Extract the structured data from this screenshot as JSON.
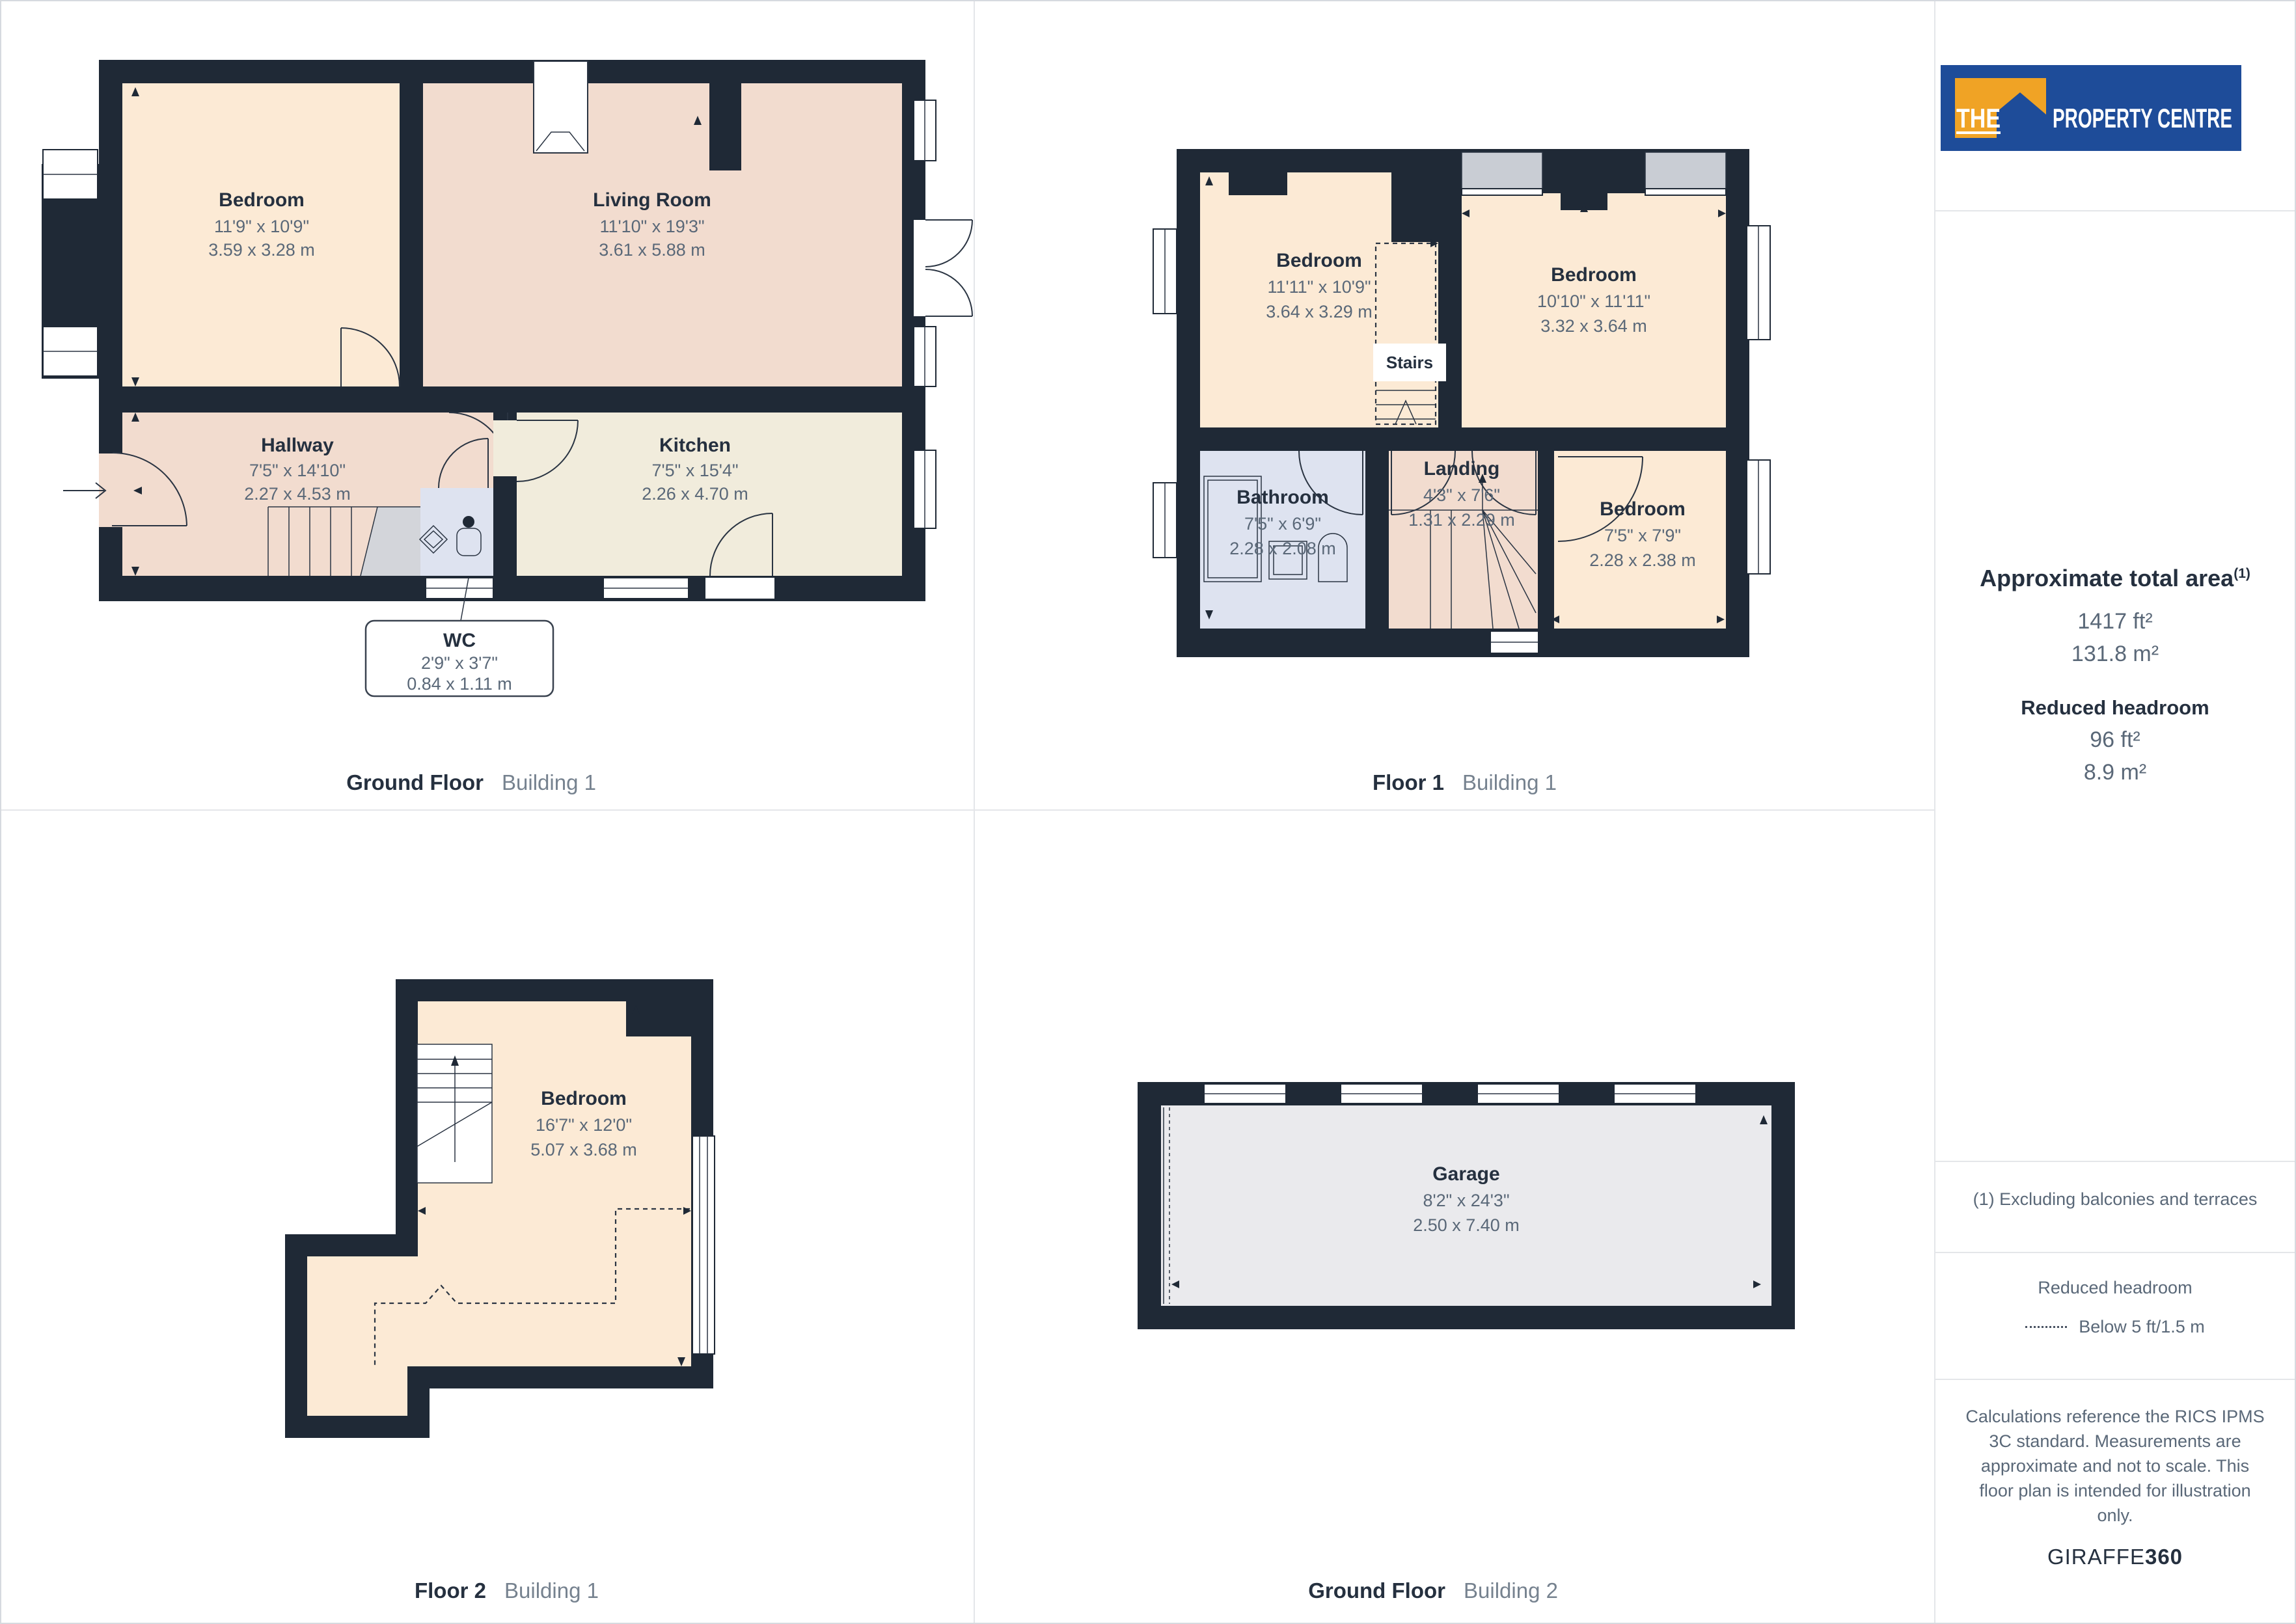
{
  "colors": {
    "wall": "#1F2936",
    "peach": "#FCEAD5",
    "pink": "#F2DCCF",
    "beige": "#F1ECDC",
    "blue": "#DEE3F0",
    "grey": "#EAEAED",
    "stair": "#D3D5DA",
    "sill": "#C9CDD4",
    "ink": "#25303F",
    "dim": "#5A6878",
    "light": "#76828F",
    "line": "#E4E6E9",
    "thin": "#2A3442",
    "logoBlue": "#1E4C99",
    "logoOrange": "#F0A325"
  },
  "branding": {
    "logo": {
      "the": "THE",
      "rest": "PROPERTY CENTRE"
    }
  },
  "plans": {
    "ground1": {
      "caption": {
        "bold": "Ground Floor",
        "light": "Building 1"
      },
      "rooms": {
        "bedroom": {
          "name": "Bedroom",
          "imperial": "11'9\" x 10'9\"",
          "metric": "3.59 x 3.28 m"
        },
        "living": {
          "name": "Living Room",
          "imperial": "11'10\" x 19'3\"",
          "metric": "3.61 x 5.88 m"
        },
        "hallway": {
          "name": "Hallway",
          "imperial": "7'5\" x 14'10\"",
          "metric": "2.27 x 4.53 m"
        },
        "kitchen": {
          "name": "Kitchen",
          "imperial": "7'5\" x 15'4\"",
          "metric": "2.26 x 4.70 m"
        },
        "wc": {
          "name": "WC",
          "imperial": "2'9\" x 3'7\"",
          "metric": "0.84 x 1.11 m"
        }
      }
    },
    "floor1": {
      "caption": {
        "bold": "Floor 1",
        "light": "Building 1"
      },
      "stairs_label": "Stairs",
      "rooms": {
        "bedroom_tl": {
          "name": "Bedroom",
          "imperial": "11'11\" x 10'9\"",
          "metric": "3.64 x 3.29 m"
        },
        "bedroom_tr": {
          "name": "Bedroom",
          "imperial": "10'10\" x 11'11\"",
          "metric": "3.32 x 3.64 m"
        },
        "bathroom": {
          "name": "Bathroom",
          "imperial": "7'5\" x 6'9\"",
          "metric": "2.28 x 2.08 m"
        },
        "landing": {
          "name": "Landing",
          "imperial": "4'3\" x 7'6\"",
          "metric": "1.31 x 2.29 m"
        },
        "bedroom_br": {
          "name": "Bedroom",
          "imperial": "7'5\" x 7'9\"",
          "metric": "2.28 x 2.38 m"
        }
      }
    },
    "floor2": {
      "caption": {
        "bold": "Floor 2",
        "light": "Building 1"
      },
      "rooms": {
        "bedroom": {
          "name": "Bedroom",
          "imperial": "16'7\" x 12'0\"",
          "metric": "5.07 x 3.68 m"
        }
      }
    },
    "ground2": {
      "caption": {
        "bold": "Ground Floor",
        "light": "Building 2"
      },
      "rooms": {
        "garage": {
          "name": "Garage",
          "imperial": "8'2\" x 24'3\"",
          "metric": "2.50 x 7.40 m"
        }
      }
    }
  },
  "sidebar": {
    "area": {
      "title": "Approximate total area",
      "title_sup": "(1)",
      "imperial": "1417 ft²",
      "metric": "131.8 m²",
      "reduced_title": "Reduced headroom",
      "reduced_imperial": "96 ft²",
      "reduced_metric": "8.9 m²"
    },
    "footnote": "(1) Excluding balconies and terraces",
    "legend": {
      "title": "Reduced headroom",
      "label": "Below 5 ft/1.5 m"
    },
    "disclaimer_lines": [
      "Calculations reference the RICS IPMS",
      "3C standard. Measurements are",
      "approximate and not to scale. This",
      "floor plan is intended for illustration",
      "only."
    ],
    "brand": {
      "giraffe": "GIRAFFE",
      "threesixty": "360"
    }
  }
}
